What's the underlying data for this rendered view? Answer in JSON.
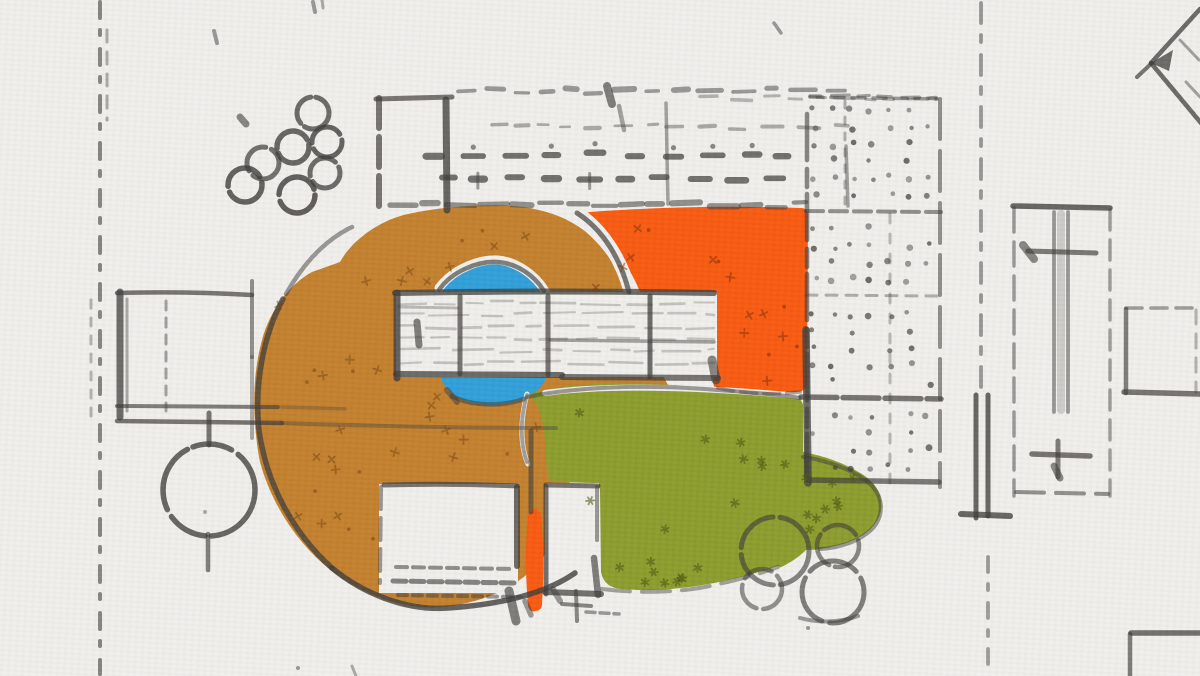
{
  "title": "Hand-drawn architectural site plan sketch with colored marker overlays",
  "palette": {
    "paper": "#f0efec",
    "pencil": "#3e3c39",
    "ochre": "#c3802d",
    "orange": "#f8590f",
    "green": "#8c9c2c",
    "blue": "#309fd9",
    "ochre_speck": "#74440f",
    "orange_speck": "#7f2c06",
    "green_speck": "#4d5813"
  },
  "regions": [
    {
      "id": "ochre-region",
      "label": "ochre highlighted courtyard ring",
      "color": "#c3802d"
    },
    {
      "id": "orange-region",
      "label": "orange highlighted terrace",
      "color": "#f8590f"
    },
    {
      "id": "green-region",
      "label": "green highlighted lawn",
      "color": "#8c9c2c"
    },
    {
      "id": "blue-pond",
      "label": "blue circular pool",
      "color": "#309fd9"
    }
  ],
  "sketch": {
    "tree_circle_count": 7,
    "bush_circle_count": 4,
    "has_north_arrow": true
  }
}
